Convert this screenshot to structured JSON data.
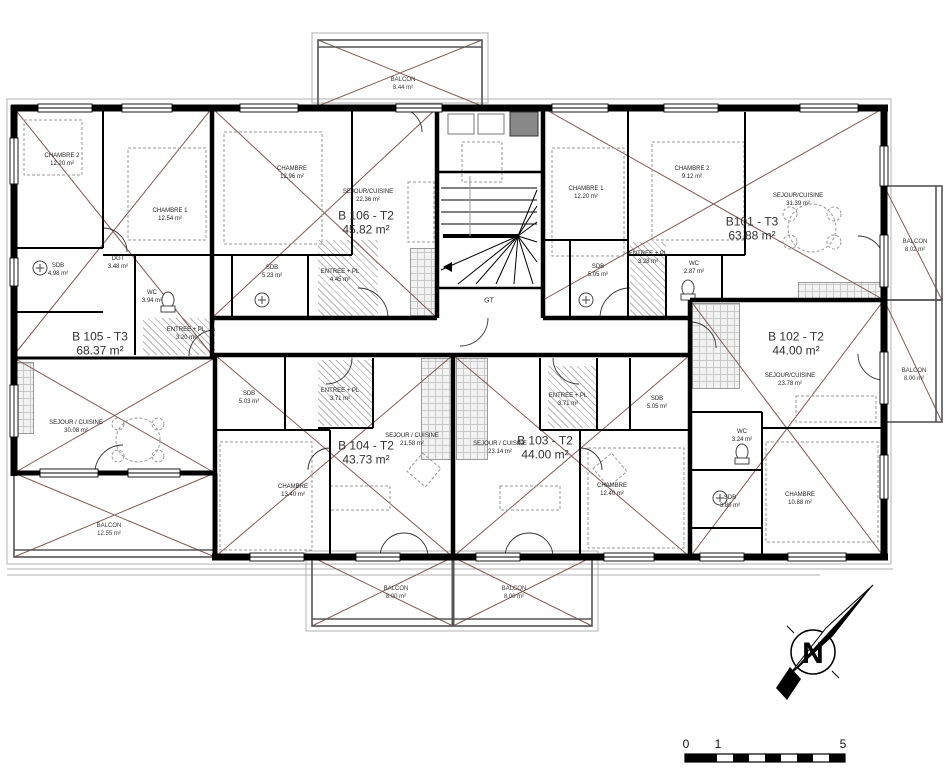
{
  "apartments": [
    {
      "id": "B105",
      "name": "B 105 - T3",
      "area": "68.37 m²",
      "rooms": [
        {
          "label": "CHAMBRE 2",
          "area": "12.20 m²"
        },
        {
          "label": "CHAMBRE 1",
          "area": "12.54 m²"
        },
        {
          "label": "SDB",
          "area": "4.98 m²"
        },
        {
          "label": "DGT",
          "area": "3.48 m²"
        },
        {
          "label": "WC",
          "area": "3.94 m²"
        },
        {
          "label": "ENTREE + PL",
          "area": "3.20 m²"
        },
        {
          "label": "SEJOUR / CUISINE",
          "area": "30.08 m²"
        }
      ]
    },
    {
      "id": "B106",
      "name": "B 106 - T2",
      "area": "45.82 m²",
      "rooms": [
        {
          "label": "CHAMBRE",
          "area": "12.96 m²"
        },
        {
          "label": "SEJOUR/CUISINE",
          "area": "22.36 m²"
        },
        {
          "label": "SDB",
          "area": "5.23 m²"
        },
        {
          "label": "ENTREE + PL",
          "area": "4.45 m²"
        }
      ]
    },
    {
      "id": "B101",
      "name": "B101 - T3",
      "area": "63.88 m²",
      "rooms": [
        {
          "label": "CHAMBRE 1",
          "area": "12.20 m²"
        },
        {
          "label": "CHAMBRE 2",
          "area": "9.12 m²"
        },
        {
          "label": "SEJOUR/CUISINE",
          "area": "31.39 m²"
        },
        {
          "label": "ENTREE + PL",
          "area": "3.28 m²"
        },
        {
          "label": "SDB",
          "area": "5.05 m²"
        },
        {
          "label": "WC",
          "area": "2.87 m²"
        }
      ]
    },
    {
      "id": "B102",
      "name": "B 102 - T2",
      "area": "44.00 m²",
      "rooms": [
        {
          "label": "SEJOUR/CUISINE",
          "area": "23.78 m²"
        },
        {
          "label": "WC",
          "area": "3.24 m²"
        },
        {
          "label": "SDB",
          "area": "3.80 m²"
        },
        {
          "label": "CHAMBRE",
          "area": "10.88 m²"
        }
      ]
    },
    {
      "id": "B104",
      "name": "B 104 - T2",
      "area": "43.73 m²",
      "rooms": [
        {
          "label": "SEJOUR / CUISINE",
          "area": "21.58 m²"
        },
        {
          "label": "ENTREE + PL",
          "area": "3.71 m²"
        },
        {
          "label": "SDB",
          "area": "5.03 m²"
        },
        {
          "label": "CHAMBRE",
          "area": "13.40 m²"
        }
      ]
    },
    {
      "id": "B103",
      "name": "B 103 - T2",
      "area": "44.00 m²",
      "rooms": [
        {
          "label": "SEJOUR / CUISINE",
          "area": "23.14 m²"
        },
        {
          "label": "ENTREE + PL",
          "area": "3.71 m²"
        },
        {
          "label": "SDB",
          "area": "5.05 m²"
        },
        {
          "label": "CHAMBRE",
          "area": "12.40 m²"
        }
      ]
    }
  ],
  "balconies": [
    {
      "label": "BALCON",
      "area": "8.44 m²",
      "position": "top"
    },
    {
      "label": "BALCON",
      "area": "8.02 m²",
      "position": "right-upper"
    },
    {
      "label": "BALCON",
      "area": "8.00 m²",
      "position": "right-lower"
    },
    {
      "label": "BALCON",
      "area": "12.55 m²",
      "position": "bottom-left"
    },
    {
      "label": "BALCON",
      "area": "8.00 m²",
      "position": "bottom-middle-left"
    },
    {
      "label": "BALCON",
      "area": "8.00 m²",
      "position": "bottom-middle-right"
    }
  ],
  "core": {
    "technical_label": "GT"
  },
  "compass": {
    "letter": "N"
  },
  "scale_bar": {
    "tick_0": "0",
    "tick_1": "1",
    "tick_5": "5"
  },
  "colors": {
    "wall": "#000000",
    "diagonal": "#7d5c55",
    "rail": "#555555",
    "background": "#ffffff"
  }
}
